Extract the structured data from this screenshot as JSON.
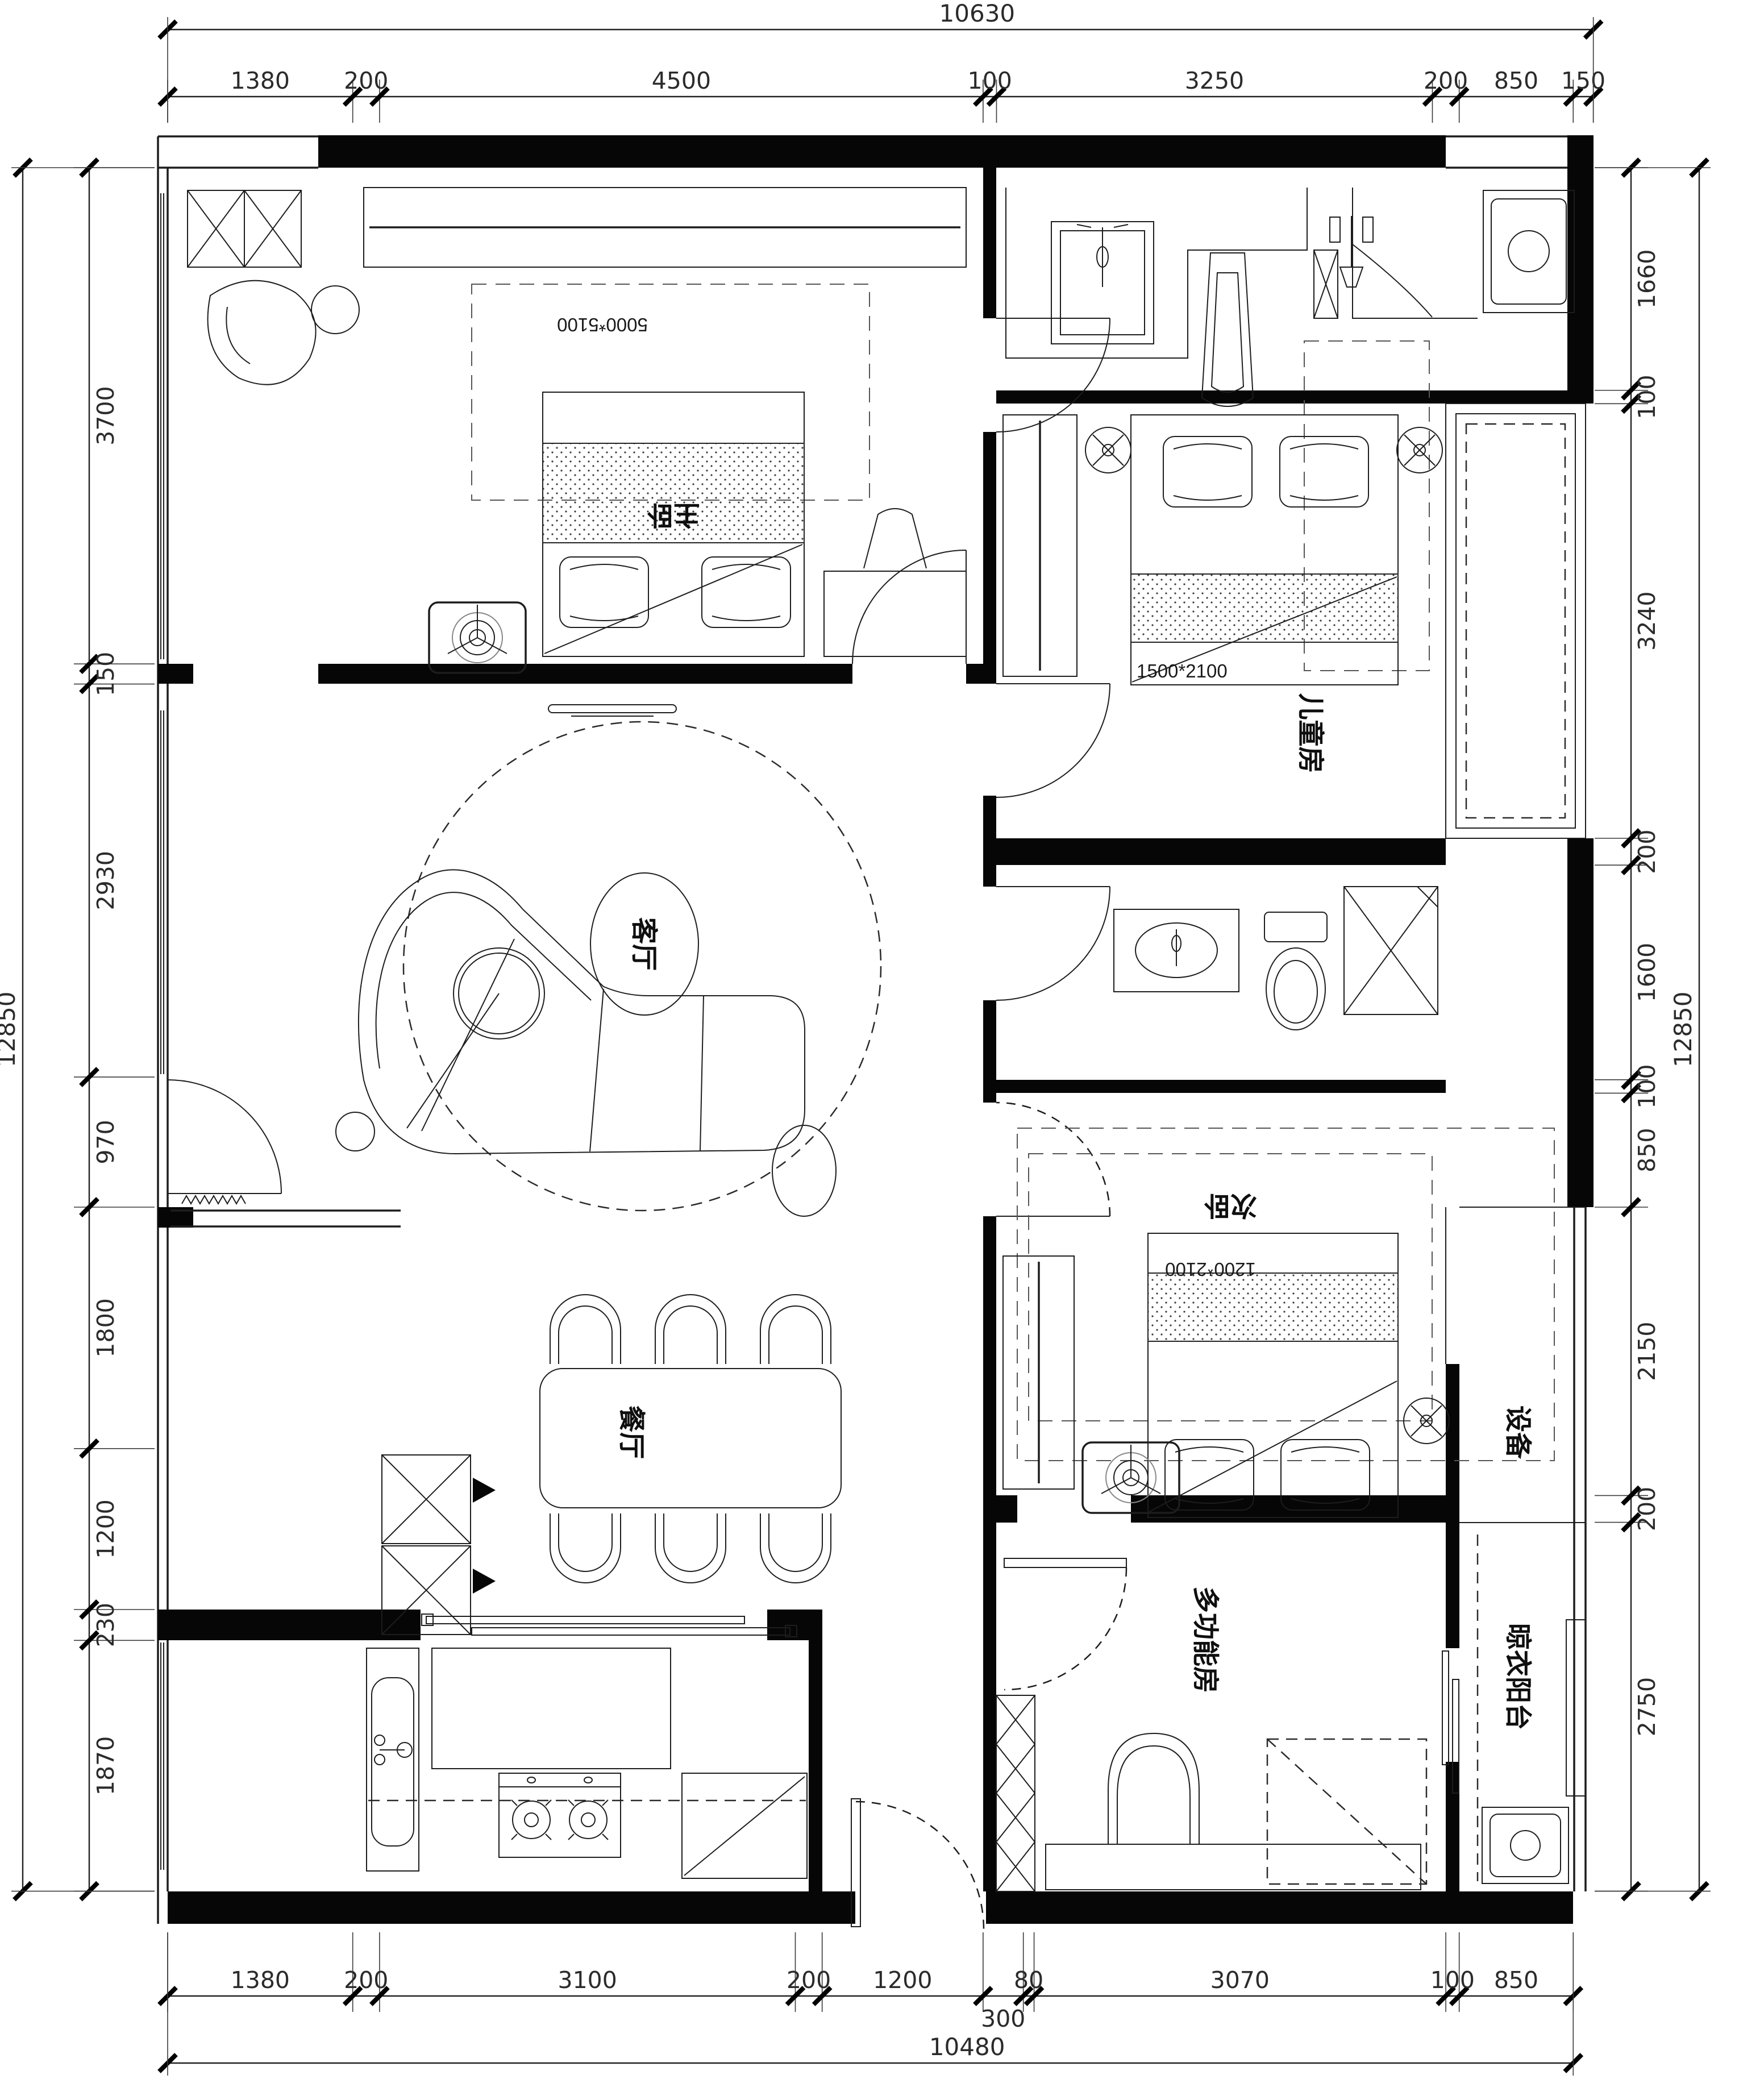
{
  "drawing": {
    "type": "floor-plan",
    "background": "#ffffff",
    "line_color": "#1d1d1d",
    "wall_color": "#060606"
  },
  "rooms": {
    "master": {
      "label": "主卧",
      "size": "5000*5100"
    },
    "kids": {
      "label": "儿童房",
      "bed": "1500*2100"
    },
    "living": {
      "label": "客厅"
    },
    "second": {
      "label": "次卧",
      "bed": "1200*2100"
    },
    "dining": {
      "label": "餐厅"
    },
    "multi": {
      "label": "多功能房"
    },
    "equipment": {
      "label": "设备"
    },
    "balcony": {
      "label": "晾衣阳台"
    }
  },
  "dims": {
    "top": {
      "total": "10630",
      "segments": [
        "1380",
        "200",
        "4500",
        "100",
        "3250",
        "200",
        "850",
        "150"
      ]
    },
    "bottom": {
      "total": "10480",
      "segments": [
        "1380",
        "200",
        "3100",
        "200",
        "1200",
        "300",
        "80",
        "3070",
        "100",
        "850"
      ],
      "dropped_label_index": 5
    },
    "left": {
      "total": "12850",
      "segments": [
        "3700",
        "150",
        "2930",
        "970",
        "1800",
        "1200",
        "230",
        "1870"
      ]
    },
    "right": {
      "total": "12850",
      "segments": [
        "1660",
        "100",
        "3240",
        "200",
        "1600",
        "100",
        "850",
        "2150",
        "200",
        "2750"
      ]
    }
  }
}
